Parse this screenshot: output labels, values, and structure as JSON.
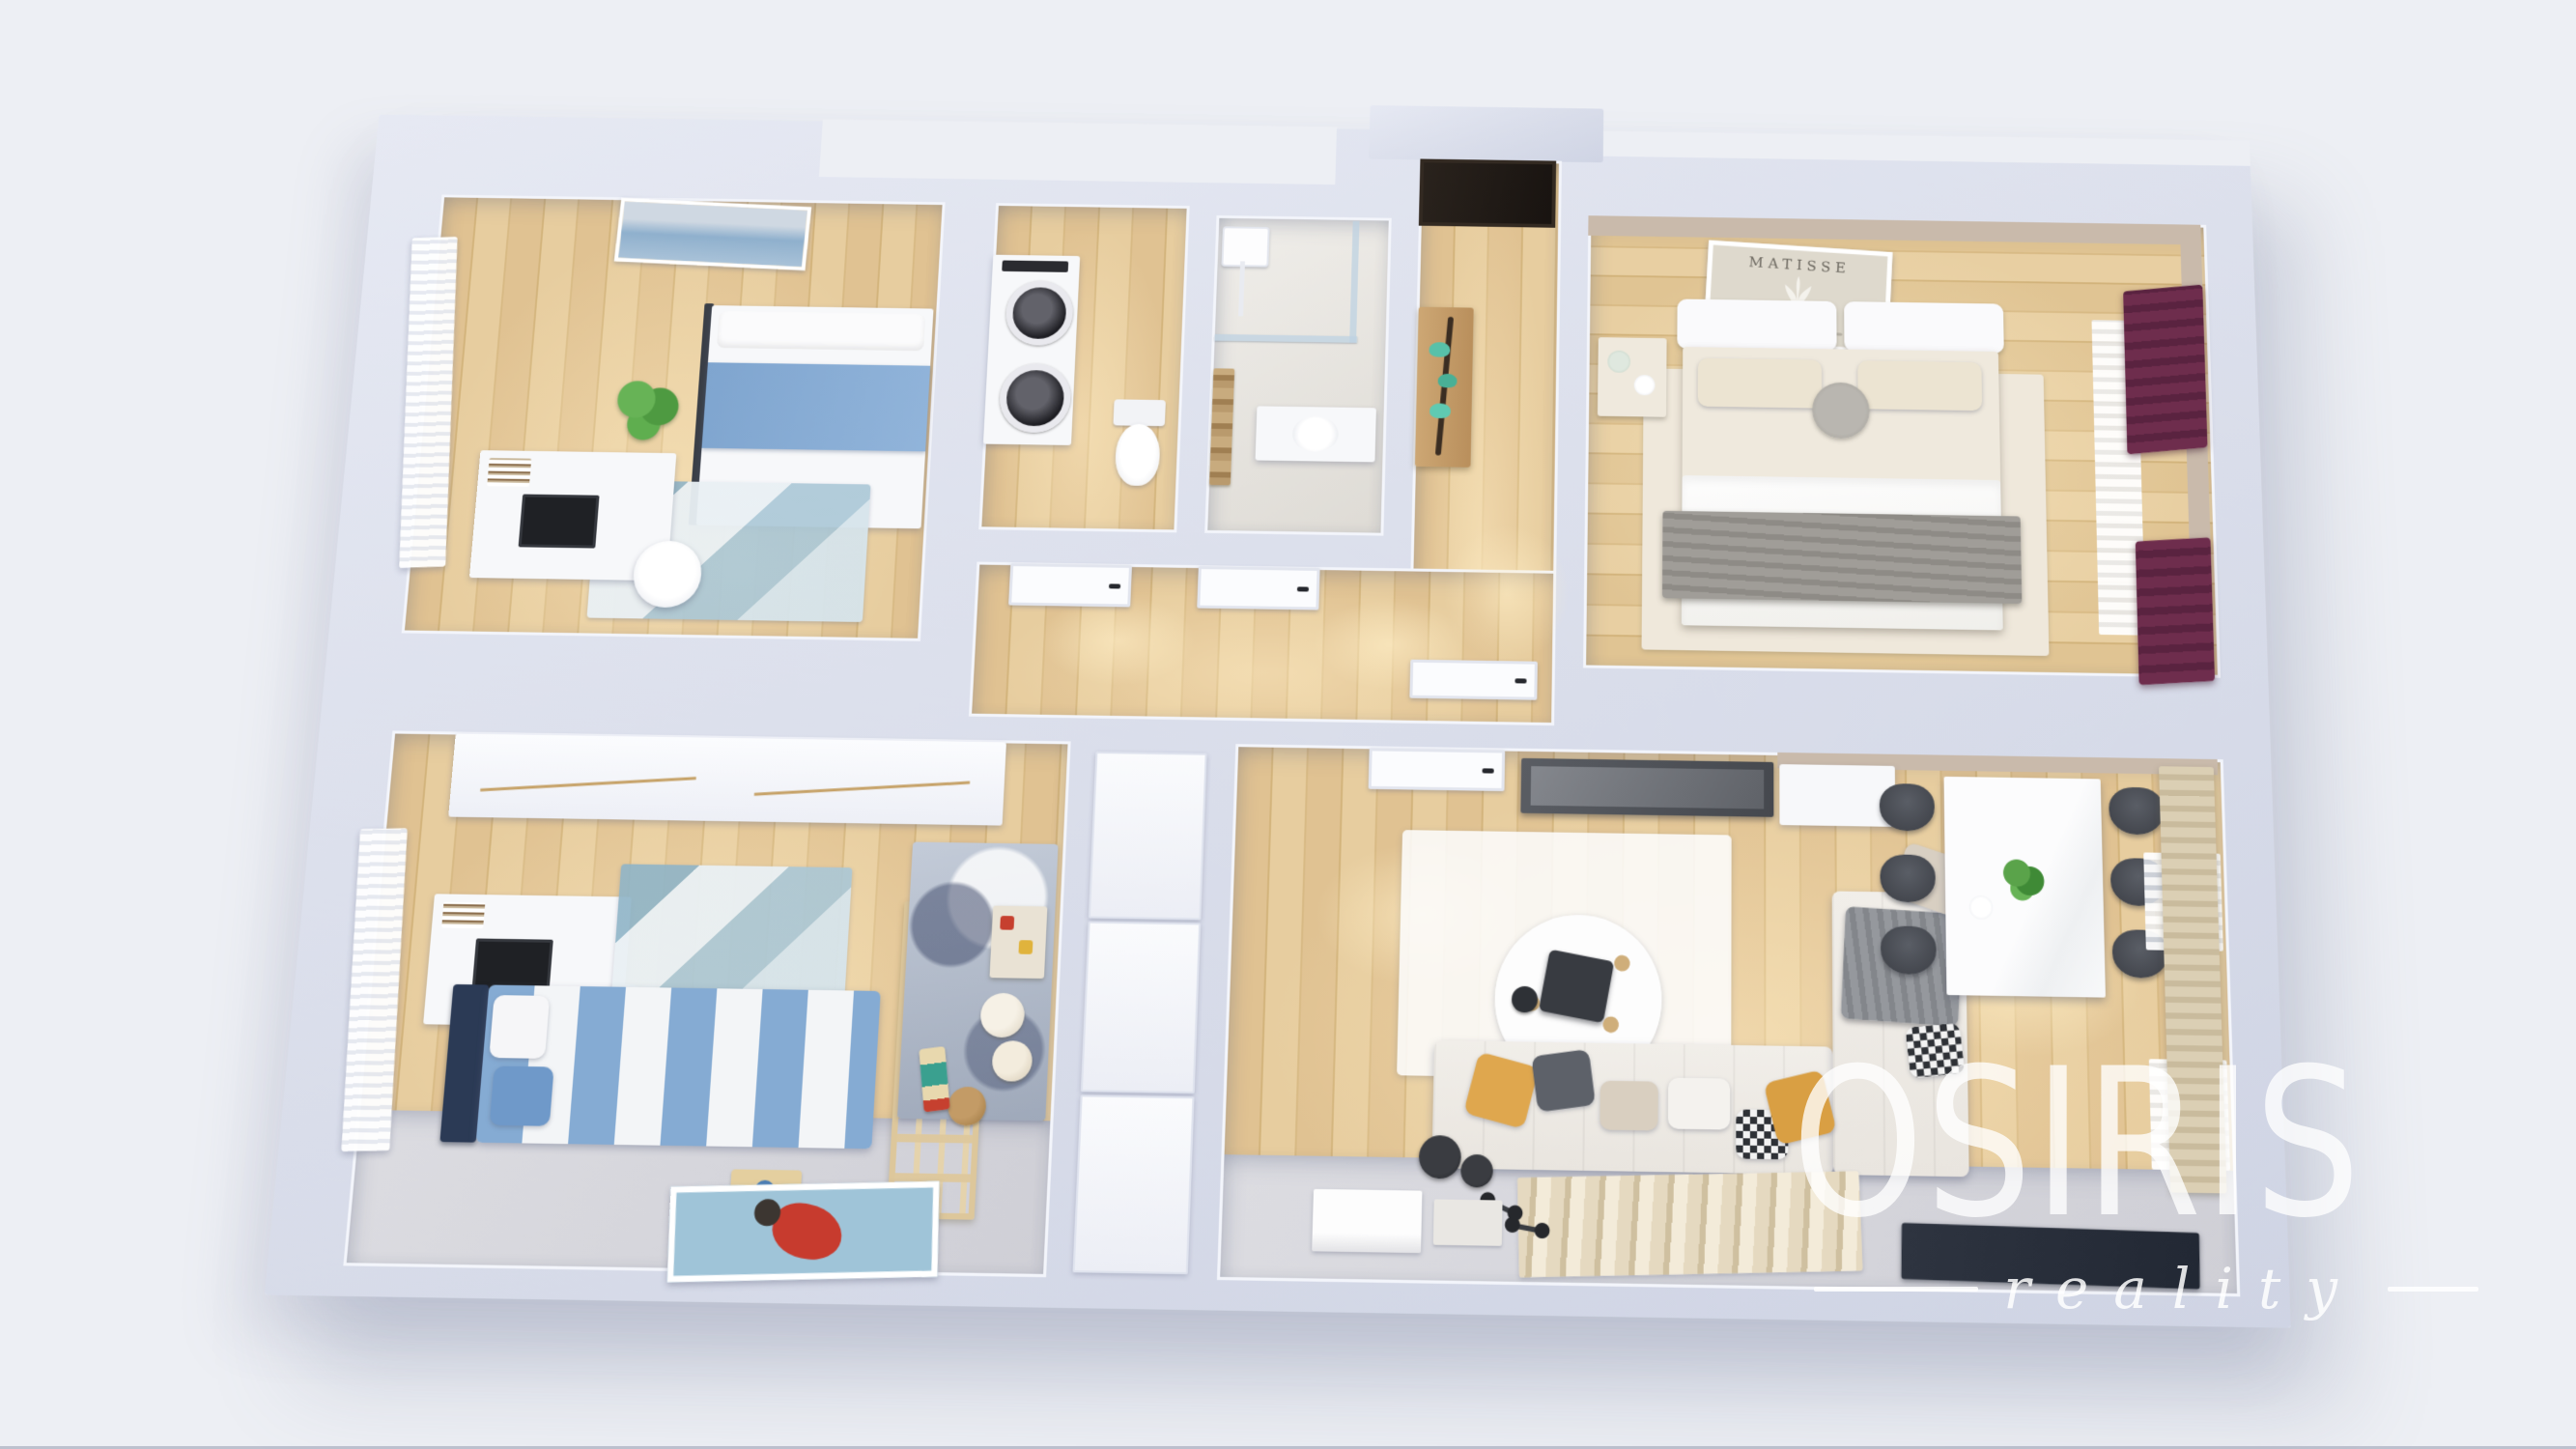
{
  "watermark": {
    "brand": "OSIRIS",
    "tagline": "reality"
  },
  "art": {
    "master_poster_title": "MATISSE"
  },
  "colors": {
    "background": "#edeff4",
    "wall": "#d9ddea",
    "wall_face": "#f3f5fb",
    "wood": "#ddbf8f",
    "gray_floor": "#d6d7dc",
    "master_wall": "#c9baab",
    "curtain_burgundy": "#6e2d4d",
    "bedding_blue": "#85abd3",
    "pillow_mustard": "#dfa74e",
    "decor_teal": "#57c1a9",
    "rug_blue": "#a9c3d2",
    "dark_door": "#26201b",
    "sofa": "#f0ede8",
    "chair_dark": "#4a4d54",
    "watermark_white": "#ffffff"
  },
  "scene": {
    "type": "3d-floor-plan-render",
    "view": "top-down axonometric cutaway of an apartment",
    "rooms": [
      {
        "id": "bedroom-top-left",
        "kind": "bedroom",
        "furniture": [
          "single bed with blue bedding",
          "white desk with black laptop",
          "white chair",
          "monstera plant",
          "geometric blue rug",
          "sheer white curtains",
          "seascape wall art"
        ]
      },
      {
        "id": "laundry-wc",
        "kind": "laundry",
        "furniture": [
          "stacked washer and dryer",
          "toilet"
        ]
      },
      {
        "id": "bathroom",
        "kind": "bathroom",
        "furniture": [
          "walk-in glass shower",
          "washbasin",
          "wooden ladder towel rack"
        ]
      },
      {
        "id": "entry-hall",
        "kind": "hallway",
        "furniture": [
          "dark entrance door",
          "wooden console with teal bird decor"
        ]
      },
      {
        "id": "master-bedroom",
        "kind": "bedroom",
        "furniture": [
          "double bed with gray throw",
          "nightstand with decor",
          "MATISSE framed poster",
          "burgundy curtains with white sheers",
          "light area rug"
        ]
      },
      {
        "id": "inner-hallway",
        "kind": "hallway",
        "furniture": [
          "open white interior doors"
        ]
      },
      {
        "id": "kids-bedroom",
        "kind": "bedroom",
        "furniture": [
          "blue-white striped bed",
          "white desk with laptop",
          "white chair",
          "wardrobe",
          "wooden lattice room divider",
          "play rug",
          "teddy bears",
          "wooden toy",
          "poster on floor",
          "sheer white curtains"
        ]
      },
      {
        "id": "closet-column",
        "kind": "storage",
        "furniture": [
          "white cabinet wall"
        ]
      },
      {
        "id": "living-dining",
        "kind": "living room",
        "furniture": [
          "L-shaped white sofa with mustard and gray pillows",
          "round white rug",
          "black coffee table",
          "wall-mounted TV",
          "marble dining table",
          "six dark chairs",
          "potted plant centerpiece",
          "black floor lamp",
          "striped runner rug",
          "dumbbells",
          "navy mat",
          "beige curtains"
        ]
      }
    ]
  }
}
